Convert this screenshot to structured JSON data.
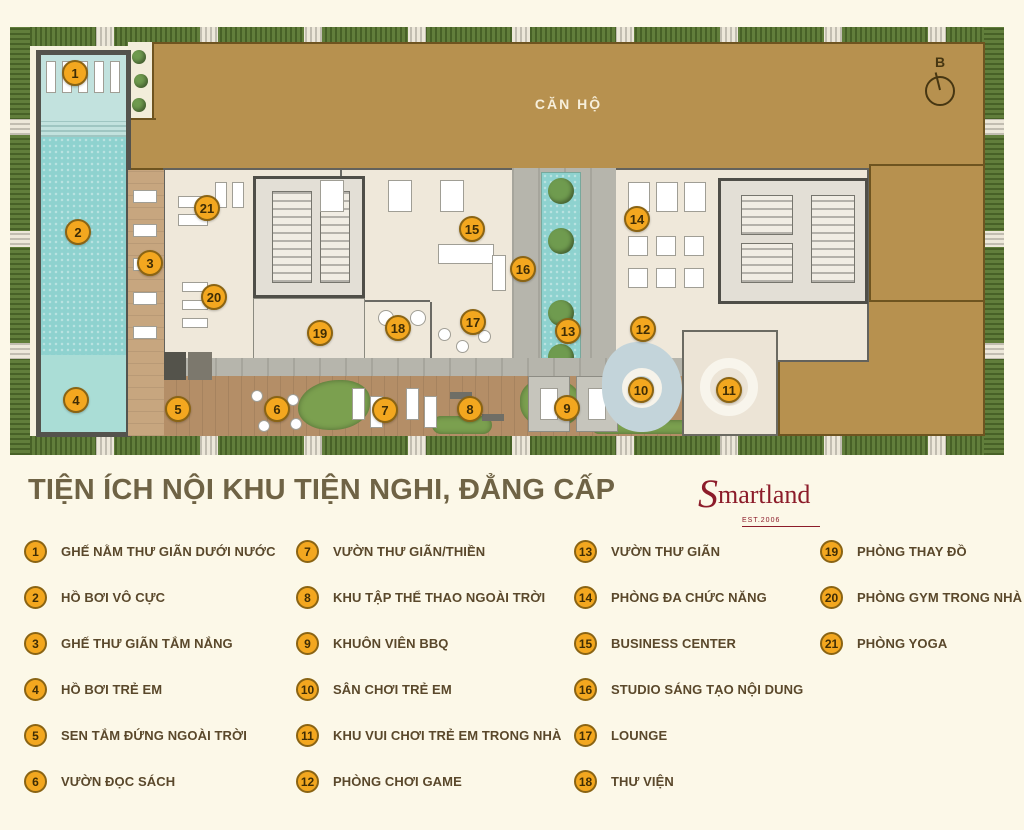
{
  "title": "TIỆN ÍCH NỘI KHU TIỆN NGHI, ĐẲNG CẤP",
  "brand": {
    "name_initial": "S",
    "name_rest": "martland",
    "est": "EST.2006"
  },
  "plan": {
    "building_label": "CĂN HỘ",
    "compass_label": "B",
    "markers": [
      {
        "num": "1",
        "x": 75,
        "y": 73
      },
      {
        "num": "2",
        "x": 78,
        "y": 232
      },
      {
        "num": "3",
        "x": 150,
        "y": 263
      },
      {
        "num": "4",
        "x": 76,
        "y": 400
      },
      {
        "num": "5",
        "x": 178,
        "y": 409
      },
      {
        "num": "6",
        "x": 277,
        "y": 409
      },
      {
        "num": "7",
        "x": 385,
        "y": 410
      },
      {
        "num": "8",
        "x": 470,
        "y": 409
      },
      {
        "num": "9",
        "x": 567,
        "y": 408
      },
      {
        "num": "10",
        "x": 641,
        "y": 390
      },
      {
        "num": "11",
        "x": 729,
        "y": 390
      },
      {
        "num": "12",
        "x": 643,
        "y": 329
      },
      {
        "num": "13",
        "x": 568,
        "y": 331
      },
      {
        "num": "14",
        "x": 637,
        "y": 219
      },
      {
        "num": "15",
        "x": 472,
        "y": 229
      },
      {
        "num": "16",
        "x": 523,
        "y": 269
      },
      {
        "num": "17",
        "x": 473,
        "y": 322
      },
      {
        "num": "18",
        "x": 398,
        "y": 328
      },
      {
        "num": "19",
        "x": 320,
        "y": 333
      },
      {
        "num": "20",
        "x": 214,
        "y": 297
      },
      {
        "num": "21",
        "x": 207,
        "y": 208
      }
    ]
  },
  "legend": {
    "columns": [
      {
        "items": [
          {
            "num": "1",
            "label": "GHẾ NẰM THƯ GIÃN DƯỚI NƯỚC"
          },
          {
            "num": "2",
            "label": "HỒ BƠI VÔ CỰC"
          },
          {
            "num": "3",
            "label": "GHẾ THƯ GIÃN TẮM NẮNG"
          },
          {
            "num": "4",
            "label": "HỒ BƠI TRẺ EM"
          },
          {
            "num": "5",
            "label": "SEN TẮM ĐỨNG NGOÀI TRỜI"
          },
          {
            "num": "6",
            "label": "VƯỜN ĐỌC SÁCH"
          }
        ]
      },
      {
        "items": [
          {
            "num": "7",
            "label": "VƯỜN THƯ GIÃN/THIỀN"
          },
          {
            "num": "8",
            "label": "KHU TẬP THỂ THAO NGOÀI TRỜI"
          },
          {
            "num": "9",
            "label": "KHUÔN VIÊN BBQ"
          },
          {
            "num": "10",
            "label": "SÂN CHƠI TRẺ EM"
          },
          {
            "num": "11",
            "label": "KHU VUI CHƠI TRẺ EM TRONG NHÀ"
          },
          {
            "num": "12",
            "label": "PHÒNG CHƠI GAME"
          }
        ]
      },
      {
        "items": [
          {
            "num": "13",
            "label": "VƯỜN THƯ GIÃN"
          },
          {
            "num": "14",
            "label": "PHÒNG ĐA CHỨC NĂNG"
          },
          {
            "num": "15",
            "label": "BUSINESS CENTER"
          },
          {
            "num": "16",
            "label": "STUDIO SÁNG TẠO NỘI DUNG"
          },
          {
            "num": "17",
            "label": "LOUNGE"
          },
          {
            "num": "18",
            "label": "THƯ VIỆN"
          }
        ]
      },
      {
        "items": [
          {
            "num": "19",
            "label": "PHÒNG THAY ĐỒ"
          },
          {
            "num": "20",
            "label": "PHÒNG GYM TRONG NHÀ"
          },
          {
            "num": "21",
            "label": "PHÒNG YOGA"
          }
        ]
      }
    ]
  },
  "colors": {
    "marker_fill": "#f3a71f",
    "marker_border": "#8a6414",
    "building_tan": "#b7914f",
    "pool_teal": "#8ed2cf",
    "hedge_green": "#57762f",
    "title_olive": "#6f6345",
    "legend_text": "#5a482b",
    "brand_red": "#8c1c2a"
  }
}
